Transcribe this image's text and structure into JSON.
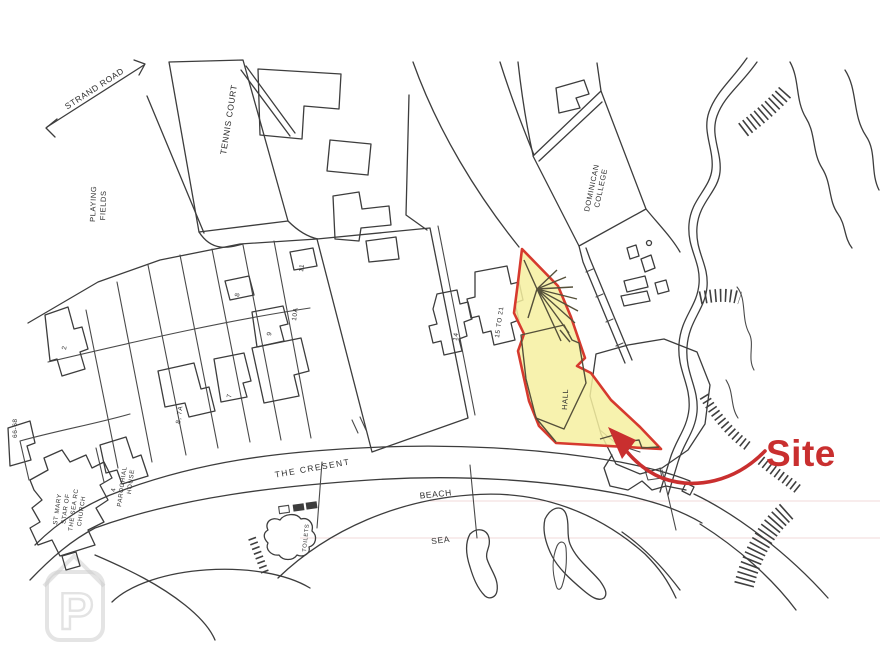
{
  "map": {
    "labels": {
      "strand_road": "STRAND ROAD",
      "playing_fields": [
        "PLAYING",
        "FIELDS"
      ],
      "tennis_court": "TENNIS COURT",
      "dominican_college": [
        "DOMINICAN",
        "COLLEGE"
      ],
      "the_cresent": "THE CRESENT",
      "beach": "BEACH",
      "sea": "SEA",
      "toilets": "TOILETS",
      "hall": "HALL",
      "site": "Site",
      "watermark_letter": "P"
    },
    "plots": {
      "no_2": "2",
      "no_8": "8",
      "no_11": "11",
      "no_9": "9",
      "no_10a": "10A",
      "no_7": "7",
      "no_8_7a": "8, 7A",
      "no_66_68": "66-68",
      "no_14": "14",
      "no_15_21": "15 TO 21"
    },
    "church_lines": [
      "ST MARY",
      "STAR OF",
      "THE SEA RC",
      "CHURCH"
    ],
    "parochial_lines": [
      "4",
      "PAROCHIAL",
      "HOUSE"
    ],
    "colors": {
      "site_fill": "#f6f0a0",
      "site_border": "#d63a2e",
      "arrow": "#c92f2f",
      "site_label": "#c92f2f",
      "linework": "#3d3d3d",
      "watermark": "#c9c9c9"
    }
  }
}
